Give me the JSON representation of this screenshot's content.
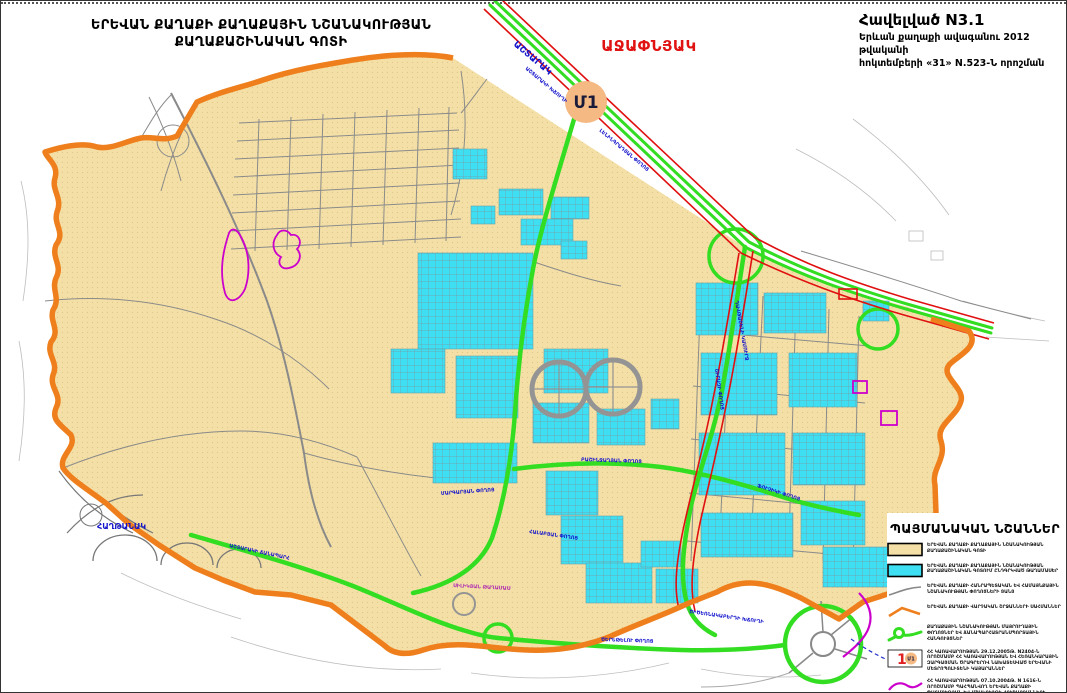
{
  "header": {
    "title_line1": "ԵՐԵՎԱՆ ՔԱՂԱՔԻ ՔԱՂԱՔԱՅԻՆ ՆՇԱՆԱԿՈՒԹՅԱՆ",
    "title_line2": "ՔԱՂԱՔԱՇԻՆԱԿԱՆ ԳՈՏԻ",
    "appendix_title": "Հավելված N3.1",
    "appendix_line1": "Երևան քաղաքի ավագանու 2012 թվականի",
    "appendix_line2": "հոկտեմբերի «31» N.523-Ն որոշման",
    "district_label": "ԱՋԱՓՆՅԱԿ"
  },
  "metro_marker": "Մ1",
  "colors": {
    "zone_tan": "#F4E0A6",
    "district_cyan": "#3EDFF2",
    "admin_border_orange": "#EE7F1C",
    "main_road_green": "#33DD22",
    "zone_line_red": "#E01010",
    "street_gray": "#8a8a8a",
    "monument_magenta": "#CC00CC",
    "label_blue": "#1414cc",
    "marker_peach": "#F5B983"
  },
  "legend": {
    "title": "ՊԱՅՄԱՆԱԿԱՆ ՆՇԱՆՆԵՐ",
    "items": [
      {
        "swatch": "tan-zone-swatch",
        "text": "ԵՐԵՎԱՆ ՔԱՂԱՔԻ ՔԱՂԱՔԱՅԻՆ ՆՇԱՆԱԿՈՒԹՅԱՆ ՔԱՂԱՔԱՇԻՆԱԿԱՆ ԳՈՏԻ"
      },
      {
        "swatch": "cyan-zone-swatch",
        "text": "ԵՐԵՎԱՆ ՔԱՂԱՔԻ ՔԱՂԱՔԱՅԻՆ ՆՇԱՆԱԿՈՒԹՅԱՆ ՔԱՂԱՔԱՇԻՆԱԿԱՆ ԳՈՏՈՒՄ ԸՆԴԳՐԿՎԱԾ ԹԱՂԱՄԱՍԵՐ"
      },
      {
        "swatch": "gray-street-swatch",
        "text": "ԵՐԵՎԱՆ ՔԱՂԱՔԻ ՀԱՆՐԱՊԵՏԱԿԱՆ ԵՎ ՀԱՄԱՅՆՔԱՅԻՆ ՆՇԱՆԱԿՈՒԹՅԱՆ ՓՈՂՈՑՆԵՐԻ ՑԱՆՑ"
      },
      {
        "swatch": "orange-border-swatch",
        "text": "ԵՐԵՎԱՆ ՔԱՂԱՔԻ ՎԱՐՉԱԿԱՆ ՇՐՋԱՆՆԵՐԻ ՍԱՀՄԱՆՆԵՐ"
      },
      {
        "swatch": "green-road-swatch",
        "text": "ՔԱՂԱՔԱՅԻՆ ՆՇԱՆԱԿՈՒԹՅԱՆ ՄԱՅՐՈՒՂԱՅԻՆ ՓՈՂՈՑՆԵՐ ԵՎ ՃԱՆԱՊԱՐՀԱՏՐԱՆՍՊՈՐՏԱՅԻՆ ՀԱՆԳՈՒՅՑՆԵՐ"
      },
      {
        "swatch": "metro-station-swatch",
        "text": "ՀՀ ԿԱՌԱՎԱՐՈՒԹՅԱՆ 29.12.2005Թ. N2404-Ն ՈՐՈՇՄԱՄԲ ՀՀ ԿԱՌԱՎԱՐՈՒԹՅԱՆ ԵՎ ՀԵՌԱՆԿԱՐԱՅԻՆ ԶԱՐԳԱՑՄԱՆ ԾՐԱԳՐԵՐՈՎ ՆԱԽԱՏԵՍՎԱԾ ԵՐԵՎԱՆԻ ՄԵՏՐՈՊՈԼԻՏԵՆԻ ԿԱՅԱՐԱՆՆԵՐ"
      },
      {
        "swatch": "magenta-line-swatch",
        "text": "ՀՀ ԿԱՌԱՎԱՐՈՒԹՅԱՆ 07.10.2004Թ. N 1616-Ն ՈՐՈՇՄԱՄԲ ՊԱՀՊԱՆՎՈՂ ԵՐԵՎԱՆ ՔԱՂԱՔԻ ՊԱՏՄՈՒԹՅԱՆ ԵՎ ՄՇԱԿՈՒՅԹԻ ՀՈՒՇԱՐՁԱՆՆԵՐԻ ՊԱՀՊԱՆԱԿԱՆ ԳՈՏԻՆԵՐԻ ՍԱՀՄԱՆՆԵՐ"
      }
    ]
  },
  "map": {
    "street_labels": [
      {
        "text": "ԱՇՏԱՐԱԿ",
        "x": 512,
        "y": 44,
        "rot": 40,
        "size": 9,
        "color": "#1414cc"
      },
      {
        "text": "ԱՇՏԱՐԱԿԻ ԽՃՈՒՂԻ",
        "x": 524,
        "y": 68,
        "rot": 40,
        "size": 5,
        "color": "#1414cc"
      },
      {
        "text": "ԼԵՆԻՆԳՐԱԴՅԱՆ ՓՈՂՈՑ",
        "x": 598,
        "y": 130,
        "rot": 40,
        "size": 5,
        "color": "#1414cc"
      },
      {
        "text": "ԴԱՎԹԱՇԵՆԻ ԿԱՄՈՒՐՋ",
        "x": 734,
        "y": 300,
        "rot": 80,
        "size": 5,
        "color": "#1414cc"
      },
      {
        "text": "ՀԱՂԹԱՆԱԿ",
        "x": 96,
        "y": 528,
        "rot": 0,
        "size": 8,
        "color": "#1414cc"
      },
      {
        "text": "ԱՇՏԱՐԱԿԻ ՃԱՆԱՊԱՐՀ",
        "x": 228,
        "y": 546,
        "rot": 12,
        "size": 5,
        "color": "#1414cc"
      },
      {
        "text": "ՄԱՐԳԱՐՅԱՆ ՓՈՂՈՑ",
        "x": 440,
        "y": 494,
        "rot": -4,
        "size": 5,
        "color": "#1414cc"
      },
      {
        "text": "ԲԱՇԻՆՋԱՂՅԱՆ ՓՈՂՈՑ",
        "x": 580,
        "y": 460,
        "rot": 2,
        "size": 5,
        "color": "#1414cc"
      },
      {
        "text": "ՇԻՐԱԶԻ ՓՈՂՈՑ",
        "x": 714,
        "y": 368,
        "rot": 82,
        "size": 5,
        "color": "#1414cc"
      },
      {
        "text": "ՖՈՒՉԻԿԻ ՓՈՂՈՑ",
        "x": 756,
        "y": 486,
        "rot": 18,
        "size": 5,
        "color": "#1414cc"
      },
      {
        "text": "ՀԱԼԱԲՅԱՆ ՓՈՂՈՑ",
        "x": 528,
        "y": 532,
        "rot": 8,
        "size": 5,
        "color": "#1414cc"
      },
      {
        "text": "ՍԻԼԻԿՅԱՆ ԹԱՂԱՄԱՍ",
        "x": 452,
        "y": 586,
        "rot": 3,
        "size": 5,
        "color": "#b030b0"
      },
      {
        "text": "ԾԵՐԵԹԵԼՈՒ ՓՈՂՈՑ",
        "x": 600,
        "y": 640,
        "rot": 2,
        "size": 5,
        "color": "#1414cc"
      },
      {
        "text": "ԾԻԾԵՌՆԱԿԱԲԵՐԴԻ ԽՃՈՒՂԻ",
        "x": 688,
        "y": 612,
        "rot": 8,
        "size": 5,
        "color": "#1414cc"
      }
    ]
  }
}
